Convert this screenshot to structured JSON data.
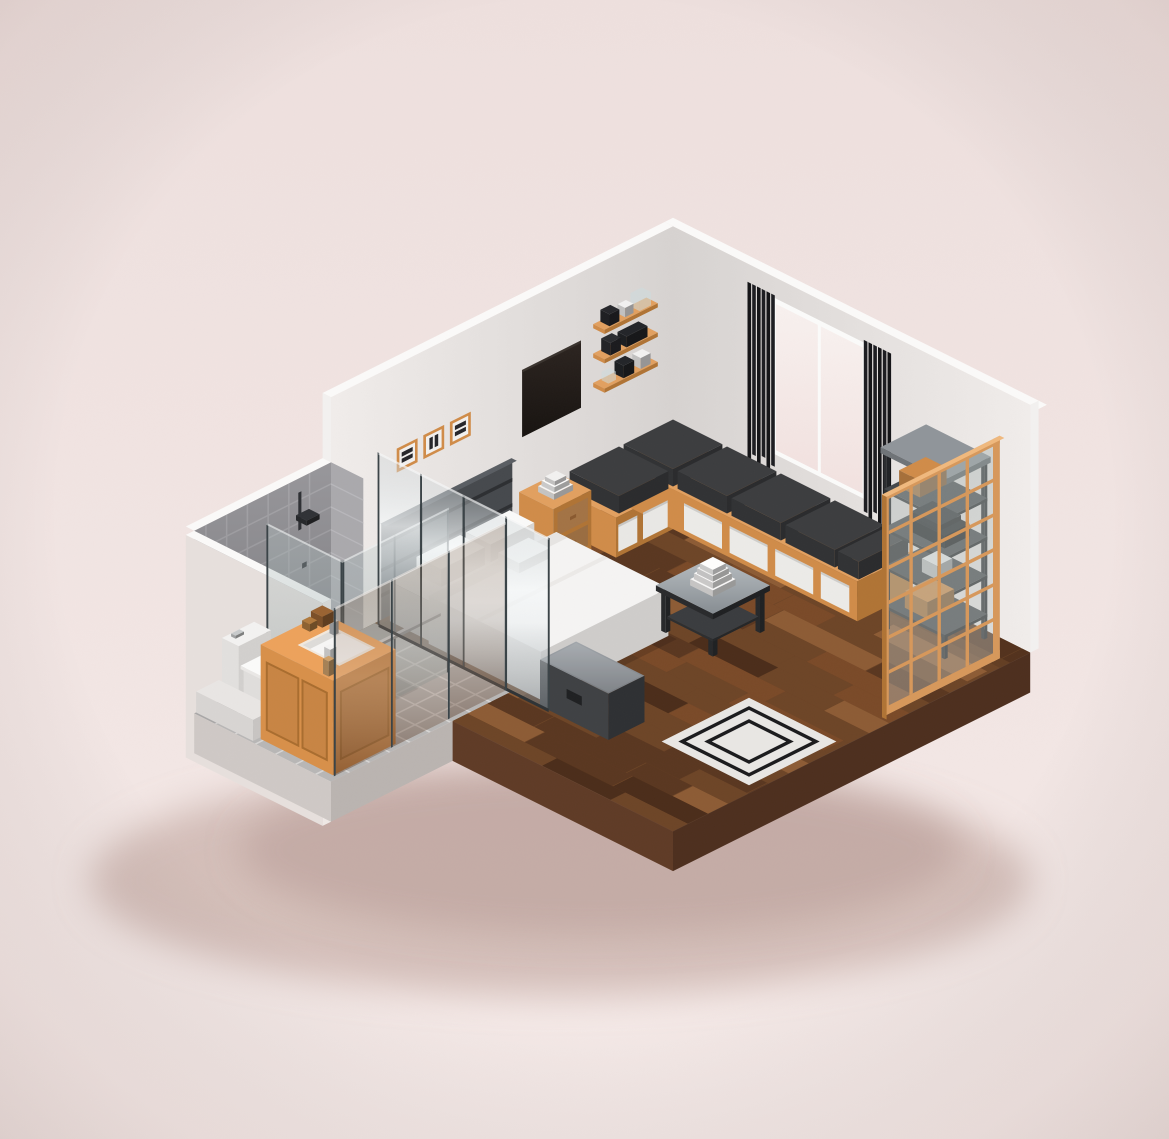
{
  "scene": {
    "kind": "isometric-voxel-render",
    "subject": "studio bedroom with en-suite bathroom",
    "palette": {
      "bgTop": "#eee0de",
      "bgBottom": "#f5eae8",
      "shadow": "rgba(186,156,150,0.55)",
      "shadow2": "rgba(170,138,132,0.35)",
      "wallLight": "#f1edeb",
      "wallDark": "#d7d3d1",
      "wallCap": "#fbfaf9",
      "wallCut": "#f3f1f0",
      "outerWall": "#e7e0dd",
      "outerWallLight": "#efe9e6",
      "tileWall": "#98979b",
      "tileWallGrout": "#a8a7ab",
      "tileWallLight": "#aaa9ad",
      "tileFloor": "#b8b7b6",
      "tileGrout": "#d8d6d5",
      "wood": "#6d4527",
      "woodMid": "#7a4a28",
      "woodLight": "#8d5c35",
      "woodDark": "#5a3720",
      "woodDarker": "#4b2d1a",
      "slabBrown": "#4d2f1e",
      "slabBrownLight": "#5f3b26",
      "slabGray": "#cfc9c6",
      "slabGrayDark": "#bab4b1",
      "orange": "#e2a060",
      "orangeMid": "#d08c49",
      "orangeDark": "#b07435",
      "orangePale": "#f0b97e",
      "white": "#f2f1f0",
      "whiteSoft": "#e6e4e2",
      "whiteBright": "#fbfbfa",
      "dark": "#46494d",
      "darker": "#2e3033",
      "black": "#17171a",
      "metal": "#8e9499",
      "metalLight": "#c7c9ca",
      "cushion": "#3c3d3f",
      "cushionSide": "#2a2b2d",
      "rug": "#e9e7e4",
      "rugLine": "#1b1b1d",
      "windowTop": "#f8f1ef",
      "windowBottom": "#f2e2e0",
      "tvTop": "#2c2420",
      "tvBottom": "#171310",
      "glassEdge": "#3a4347",
      "bedWhite": "#f1f0ef",
      "duvetWhite": "#f5f4f3",
      "pillowWhite": "#fafaf9",
      "vanityTop": "#eda25c",
      "vanityX": "#d8904a",
      "vanityY": "#c07c3c",
      "sink": "#f7f6f5",
      "bottleTan": "#cfa16b",
      "crate": "#9a6332"
    },
    "objects": [
      {
        "name": "background",
        "label": "pink studio backdrop"
      },
      {
        "name": "ground-shadow",
        "label": "soft drop shadow under floor slab"
      },
      {
        "name": "right-wall",
        "label": "back-right wall"
      },
      {
        "name": "left-wall",
        "label": "back-left wall"
      },
      {
        "name": "bathroom-walls",
        "label": "gray tiled bathroom walls"
      },
      {
        "name": "window",
        "label": "glowing window panes"
      },
      {
        "name": "curtains",
        "label": "black slat curtains"
      },
      {
        "name": "wall-shelves",
        "label": "three wooden wall shelves with decor"
      },
      {
        "name": "tv-panel",
        "label": "wall-mounted dark TV panel"
      },
      {
        "name": "picture-frames",
        "label": "three small framed artworks"
      },
      {
        "name": "headboard",
        "label": "dark slatted headboard"
      },
      {
        "name": "floor",
        "label": "wood plank floor and tiled bathroom floor"
      },
      {
        "name": "rug",
        "label": "light rug with double black border"
      },
      {
        "name": "corner-bench",
        "label": "L-shaped bench with cushions and drawer bins"
      },
      {
        "name": "nightstand",
        "label": "orange two-drawer nightstand"
      },
      {
        "name": "ladder-shelf",
        "label": "dark metal etagere shelf"
      },
      {
        "name": "bed",
        "label": "white double bed with pillows and duvet"
      },
      {
        "name": "storage-chest",
        "label": "dark storage chest at bed foot"
      },
      {
        "name": "coffee-table",
        "label": "glass-top coffee table with stacked boxes"
      },
      {
        "name": "shower",
        "label": "glass shower enclosure with fittings"
      },
      {
        "name": "toilet",
        "label": "white toilet"
      },
      {
        "name": "shower-curb",
        "label": "low white ledge"
      },
      {
        "name": "bathroom-vanity",
        "label": "orange vanity with inset sink"
      },
      {
        "name": "glass-partition",
        "label": "mirror-like glass partition in front of bed"
      },
      {
        "name": "glass-divider",
        "label": "glass divider behind vanity"
      },
      {
        "name": "grid-partition",
        "label": "orange-framed glazed grid screen"
      },
      {
        "name": "finish-overlay",
        "label": "render grain and vignette"
      }
    ]
  }
}
